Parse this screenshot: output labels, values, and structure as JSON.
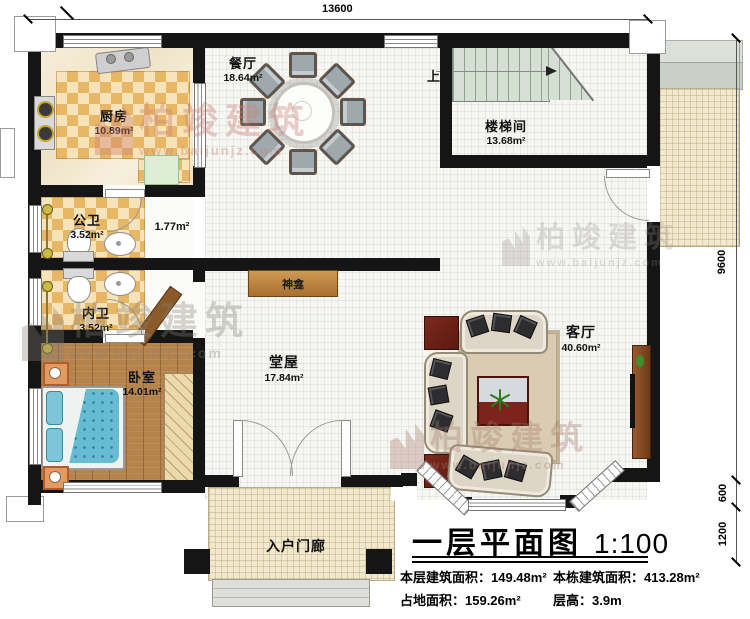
{
  "brand": {
    "name": "柏竣建筑",
    "url": "www.baijunjz.com"
  },
  "dims": {
    "top": "13600",
    "main_height": "9600",
    "bay": "600",
    "porch": "1200"
  },
  "rooms": {
    "kitchen": {
      "name": "厨房",
      "area": "10.89m²"
    },
    "dining": {
      "name": "餐厅",
      "area": "18.64m²"
    },
    "stairwell": {
      "name": "楼梯间",
      "area": "13.68m²",
      "up_label": "上"
    },
    "public_bath": {
      "name": "公卫",
      "area": "3.52m²"
    },
    "corridor": {
      "area": "1.77m²"
    },
    "private_bath": {
      "name": "内卫",
      "area": "3.52m²"
    },
    "bedroom": {
      "name": "卧室",
      "area": "14.01m²"
    },
    "main_hall": {
      "name": "堂屋",
      "area": "17.84m²"
    },
    "shrine": {
      "name": "神龛"
    },
    "living": {
      "name": "客厅",
      "area": "40.60m²"
    },
    "porch": {
      "name": "入户门廊"
    }
  },
  "title_block": {
    "title": "一层平面图",
    "scale": "1:100",
    "stats": [
      {
        "text": "本层建筑面积：149.48m²"
      },
      {
        "text": "本栋建筑面积：413.28m²"
      },
      {
        "text": "占地面积：159.26m²"
      },
      {
        "text": "层高：3.9m"
      }
    ]
  },
  "colors": {
    "wall": "#151515",
    "tile_checker": "#e8b766",
    "wood_floor": "#b5834c",
    "patio_tile": "#f1e8cd",
    "stair_tread": "#d6dfd3",
    "shrine_wood": "#b77b38",
    "accent_red": "#6e241c"
  }
}
